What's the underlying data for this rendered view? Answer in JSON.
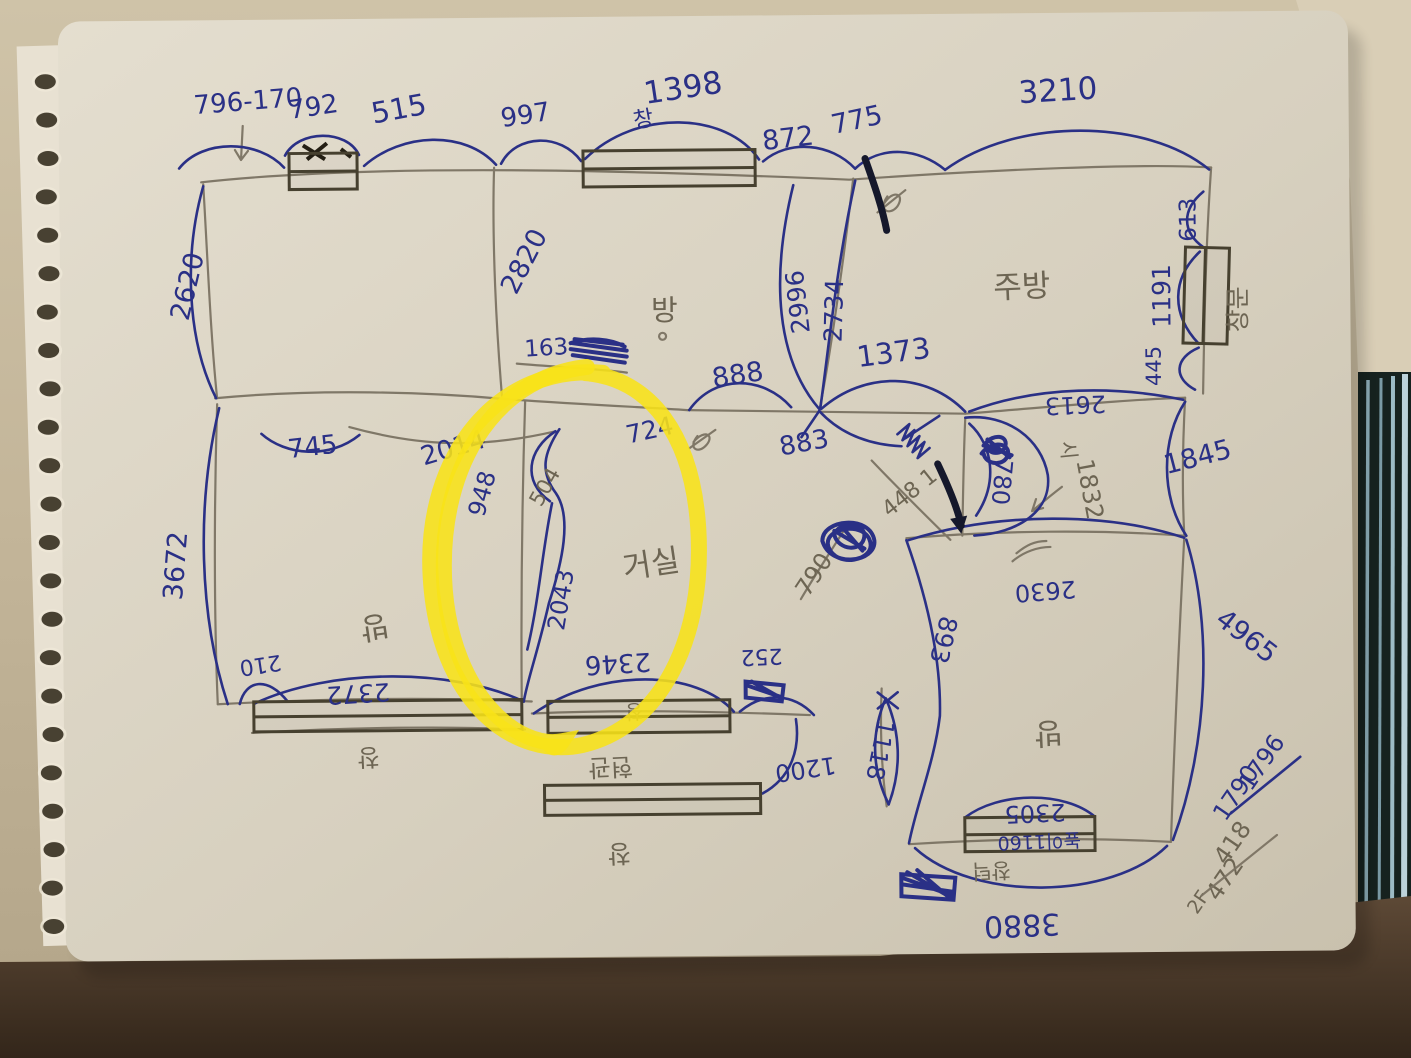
{
  "floorplan": {
    "rooms": {
      "room1": "방",
      "kitchen": "주방",
      "living": "거실",
      "room2": "방",
      "room3": "방"
    },
    "top": {
      "d796_170": "796-170",
      "d792": "792",
      "d515": "515",
      "d997": "997",
      "win": "창",
      "d1398": "1398",
      "d872": "872",
      "d775": "775",
      "d3210": "3210"
    },
    "right": {
      "d613": "613",
      "win": "창문",
      "d1191": "1191",
      "d445": "445",
      "d2613": "2613",
      "d1845": "1845",
      "d4965": "4965"
    },
    "left": {
      "d2620": "2620",
      "d745": "745",
      "d3672": "3672",
      "d210": "210"
    },
    "center": {
      "d2820": "2820",
      "d163": "163",
      "d2996": "2996",
      "d2734": "2734",
      "d888": "888",
      "d883": "883",
      "d1373": "1373",
      "d724": "724",
      "d2014": "2014",
      "d948": "948",
      "d504": "504",
      "d2043": "2043"
    },
    "entrance": {
      "d780": "780",
      "d1832": "1832",
      "note_448": "448 1",
      "d790": "790",
      "note_si": "시"
    },
    "bottom_left": {
      "d2372": "2372",
      "win": "창"
    },
    "bottom_middle": {
      "d2346": "2346",
      "win_upper": "창",
      "win_lower": "창",
      "door": "현관",
      "d252": "252",
      "d1200": "1200",
      "d1118": "1118"
    },
    "bottom_right": {
      "d2630": "2630",
      "d893": "893",
      "d2305": "2305",
      "height_note": "높이1160",
      "sill_note": "창턱",
      "d3880": "3880"
    },
    "calc": {
      "ink_top": "1796",
      "ink_bottom": "1790",
      "pencil_top": "418",
      "pencil_bottom": "472",
      "floor": "2F"
    },
    "colors": {
      "ink": "#2a3086",
      "pencil": "#6d6553",
      "highlighter": "#f8e318"
    }
  }
}
